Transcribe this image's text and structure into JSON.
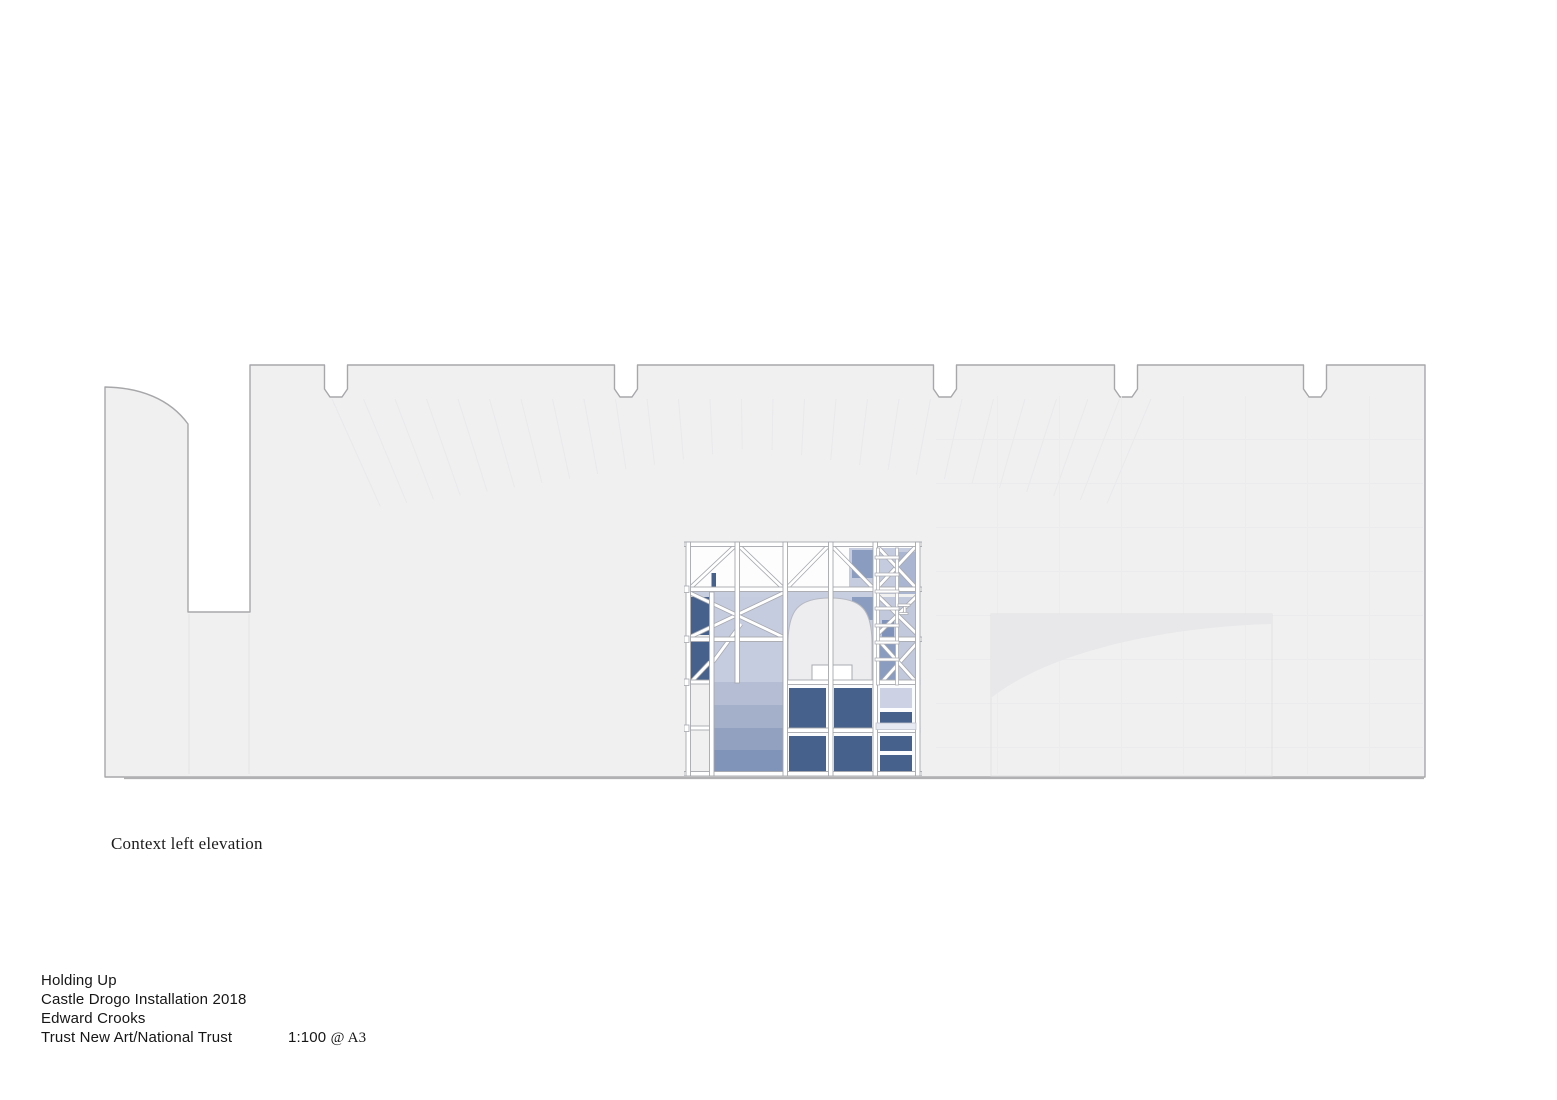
{
  "annotation": {
    "view_label": "Context left elevation"
  },
  "title_block": {
    "project": "Holding Up",
    "installation": "Castle Drogo Installation 2018",
    "author": "Edward Crooks",
    "client": "Trust New Art/National Trust",
    "scale": "1:100",
    "paper": "@ A3"
  },
  "colors": {
    "wall_fill": "#f0f0f1",
    "wall_outline": "#a7a7aa",
    "ground_line": "#b1b1b4",
    "faint_line": "#e9e9eb",
    "arch_wedge": "#e8e8ea",
    "panel_navy": "#46618c",
    "panel_medium": "#8a9cc0",
    "panel_lavender": "#c2c9dc",
    "panel_light_band": "#c7cedf",
    "arch_fill": "#ededf0",
    "member_fill": "#ffffff",
    "member_edge": "#a6a8ad",
    "gradient_bands": [
      "#c5cce0",
      "#b4bdd4",
      "#a4afca",
      "#93a1c1",
      "#8093b8"
    ]
  }
}
